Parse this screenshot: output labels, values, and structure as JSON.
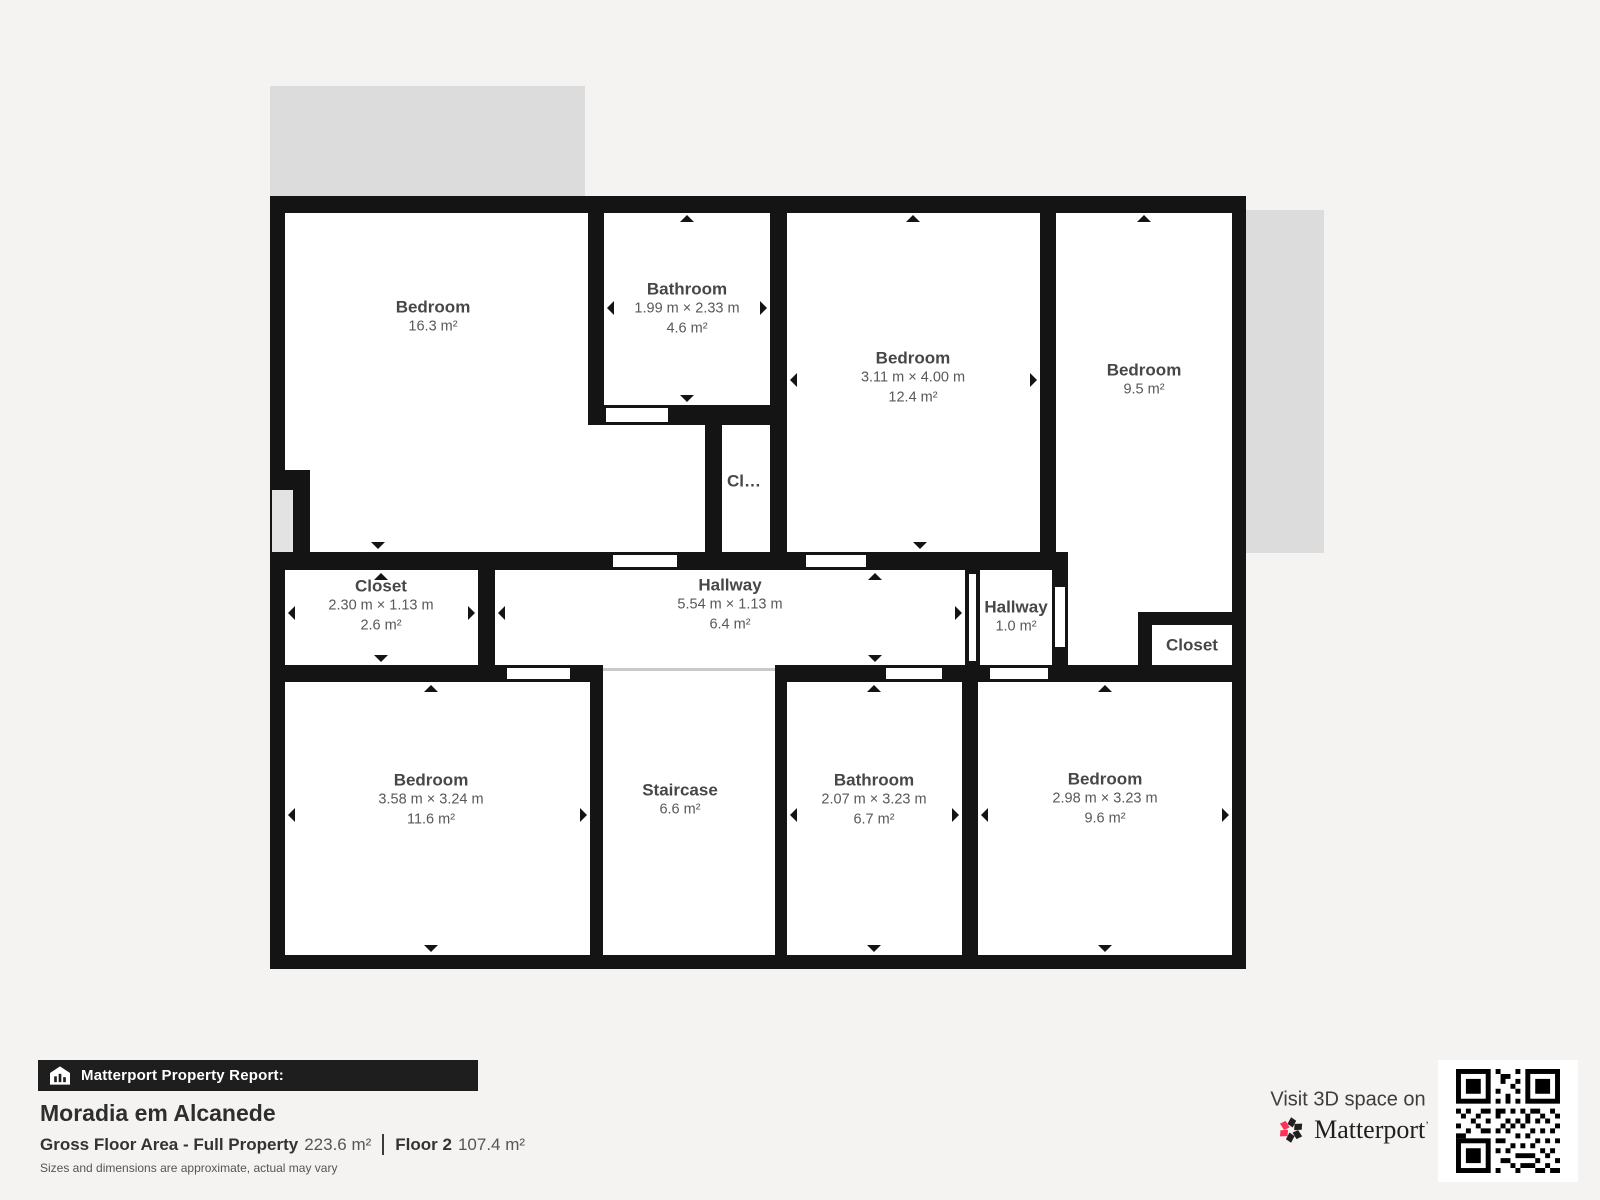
{
  "plan": {
    "rooms": [
      {
        "id": "bedroom-16",
        "name": "Bedroom",
        "area": "16.3 m²"
      },
      {
        "id": "bathroom-46",
        "name": "Bathroom",
        "dims": "1.99 m × 2.33 m",
        "area": "4.6 m²"
      },
      {
        "id": "closet-cl",
        "name": "Cl…"
      },
      {
        "id": "bedroom-124",
        "name": "Bedroom",
        "dims": "3.11 m × 4.00 m",
        "area": "12.4 m²"
      },
      {
        "id": "bedroom-95",
        "name": "Bedroom",
        "area": "9.5 m²"
      },
      {
        "id": "closet-26",
        "name": "Closet",
        "dims": "2.30 m × 1.13 m",
        "area": "2.6 m²"
      },
      {
        "id": "hallway-64",
        "name": "Hallway",
        "dims": "5.54 m × 1.13 m",
        "area": "6.4 m²"
      },
      {
        "id": "hallway-10",
        "name": "Hallway",
        "area": "1.0 m²"
      },
      {
        "id": "closet-right",
        "name": "Closet"
      },
      {
        "id": "bedroom-116",
        "name": "Bedroom",
        "dims": "3.58 m × 3.24 m",
        "area": "11.6 m²"
      },
      {
        "id": "staircase",
        "name": "Staircase",
        "area": "6.6 m²"
      },
      {
        "id": "bathroom-67",
        "name": "Bathroom",
        "dims": "2.07 m × 3.23 m",
        "area": "6.7 m²"
      },
      {
        "id": "bedroom-96",
        "name": "Bedroom",
        "dims": "2.98 m × 3.23 m",
        "area": "9.6 m²"
      }
    ]
  },
  "footer": {
    "report_label": "Matterport Property Report:",
    "property_name": "Moradia em Alcanede",
    "gross_label": "Gross Floor Area - Full Property",
    "gross_value": "223.6 m²",
    "floor_label": "Floor 2",
    "floor_value": "107.4 m²",
    "disclaimer": "Sizes and dimensions are approximate, actual may vary",
    "visit_text": "Visit 3D space on",
    "brand": "Matterport",
    "brand_mark": "’"
  },
  "colors": {
    "wall": "#141414",
    "room_fill": "#ffffff",
    "balcony": "#dcdcdc",
    "background": "#f4f3f1",
    "bar_background": "#1e1e1e",
    "brand_red": "#ff3158",
    "label_text": "#474747"
  }
}
